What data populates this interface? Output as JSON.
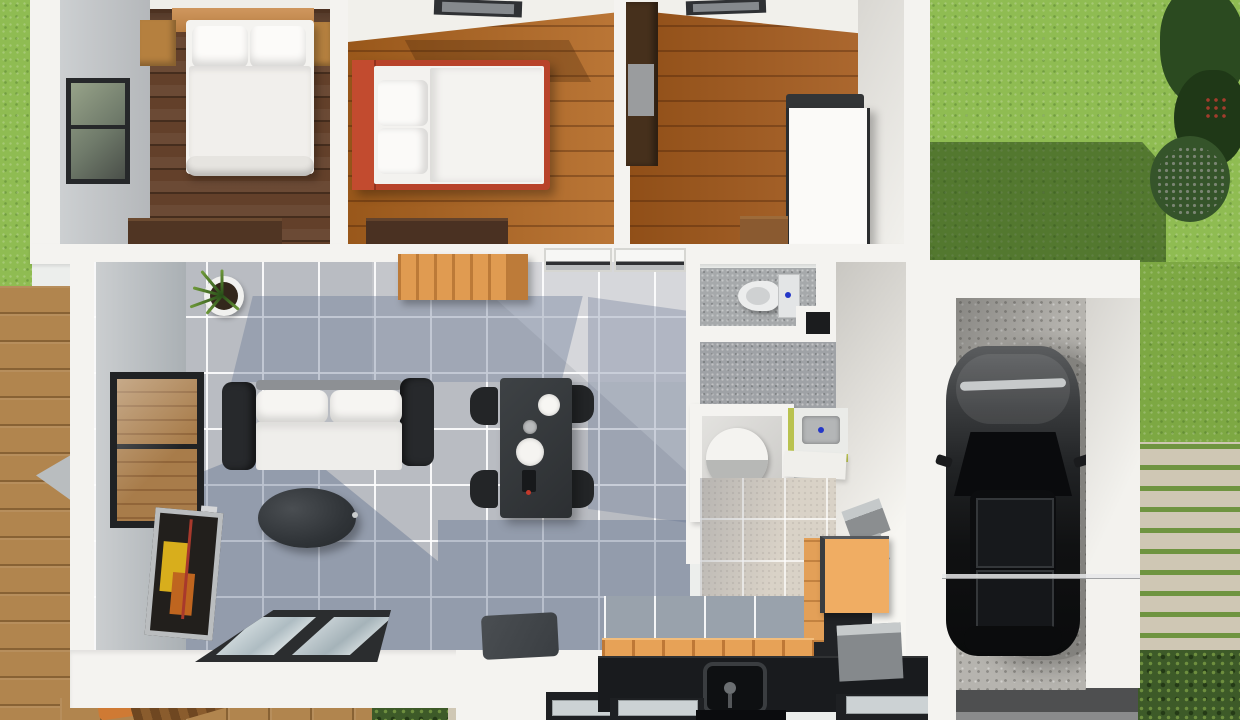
{
  "scene": {
    "title": "3D floor plan render - single-storey house with garage, deck and yard",
    "rooms": {
      "bedroom_main": {
        "label": "Main bedroom - double bed with wooden headboard and nightstands"
      },
      "bedroom_two": {
        "label": "Second bedroom - red frame bed with white bedding, rooflight"
      },
      "bedroom_three": {
        "label": "Third room - dark wardrobe, tall white cabinet, rooflight"
      },
      "living_room": {
        "label": "Living room - black and white sofa, leaning TV, oval coffee table, plant"
      },
      "dining_area": {
        "label": "Dining area - dark table with four black chairs and white plates"
      },
      "kitchen": {
        "label": "Kitchen - black counter with sink, timber bench and orange cabinets"
      },
      "wc": {
        "label": "WC - toilet with cistern on gray tile"
      },
      "bathroom": {
        "label": "Bathroom - round white tub in alcove, basin on green cabinet"
      },
      "laundry": {
        "label": "Laundry corner on beige tile"
      },
      "garage": {
        "label": "Garage - dark car parked on concrete slab"
      },
      "deck": {
        "label": "Timber deck with outdoor chair"
      },
      "yard": {
        "label": "Lawn with tree and cast shadow"
      },
      "path": {
        "label": "Stone garden path with moss joints"
      },
      "driveway": {
        "label": "Dark driveway strip"
      }
    },
    "counts": {
      "dining_chairs": 4,
      "beds": 2,
      "rooflights": 2,
      "sofa_back_pillows": 2
    },
    "palette": {
      "lawn": "#8fbc52",
      "lawn_shadow": "#46682c",
      "foliage": "#2b4a20",
      "deck_wood": "#b1854e",
      "wall_white": "#f4f3f0",
      "floor_walnut": "#63402a",
      "floor_oak": "#b2661f",
      "tile_gray": "#b9bcc2",
      "tile_shadow_blue": "#5f7090",
      "bath_tile": "#a6a9ab",
      "laundry_tile": "#d9d2c7",
      "counter_black": "#191b1e",
      "cabinet_orange": "#e7a257",
      "bed_frame_red": "#b8432a",
      "sofa_frame": "#27292c",
      "linen": "#f4f3f0",
      "concrete": "#b6b4af",
      "car_body": "#141517",
      "driveway": "#4e4f50",
      "stone": "#cfc7b4",
      "sink_cabinet": "#b9c24f"
    }
  }
}
